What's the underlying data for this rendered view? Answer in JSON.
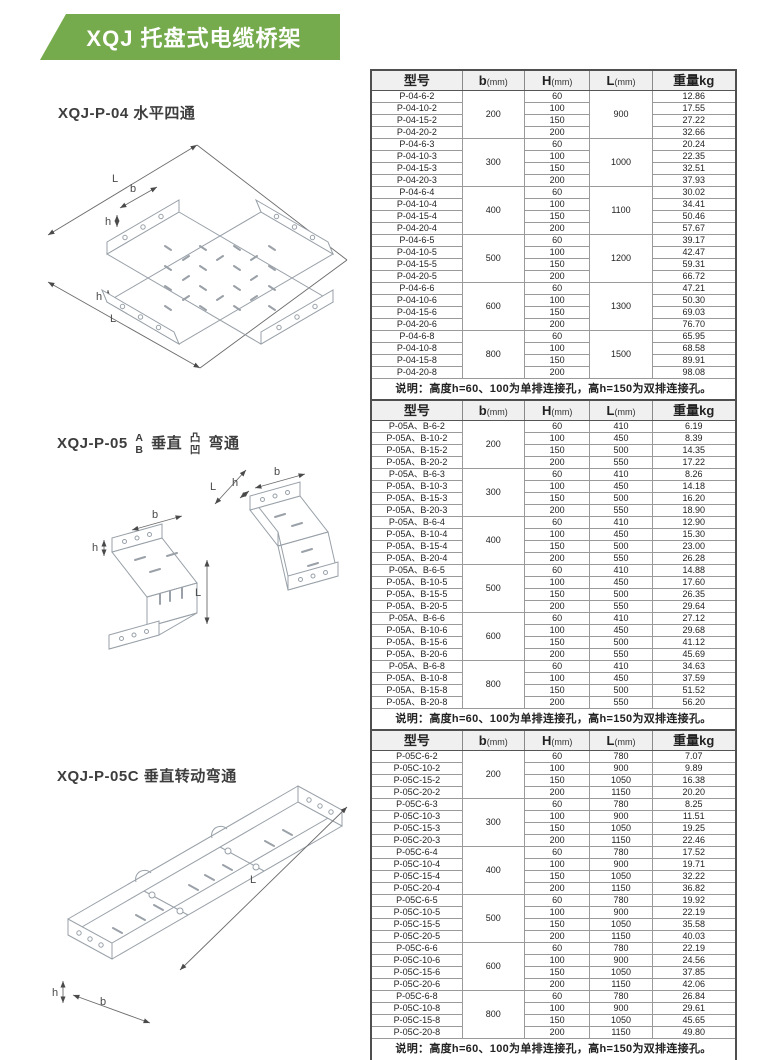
{
  "page": {
    "title": "XQJ 托盘式电缆桥架",
    "banner_color": "#76ab4d"
  },
  "figures": [
    {
      "label": "XQJ-P-04 水平四通",
      "dims": [
        "L",
        "b",
        "h",
        "h",
        "L"
      ]
    },
    {
      "parts": {
        "prefix": "XQJ-P-05",
        "ab": [
          "A",
          "B"
        ],
        "mid": "垂直",
        "tuao": [
          "凸",
          "凹"
        ],
        "suffix": "弯通"
      },
      "dims": [
        "h",
        "b",
        "L",
        "L",
        "h",
        "b"
      ]
    },
    {
      "label": "XQJ-P-05C 垂直转动弯通",
      "dims": [
        "L",
        "h",
        "b"
      ]
    }
  ],
  "tables": [
    {
      "headers": [
        {
          "t": "型号"
        },
        {
          "t": "b",
          "u": "(mm)"
        },
        {
          "t": "H",
          "u": "(mm)"
        },
        {
          "t": "L",
          "u": "(mm)"
        },
        {
          "t": "重量kg"
        }
      ],
      "note": "说明：高度h=60、100为单排连接孔，高h=150为双排连接孔。",
      "groups": [
        {
          "b": "200",
          "L": "900",
          "rows": [
            [
              "P-04-6-2",
              "60",
              "12.86"
            ],
            [
              "P-04-10-2",
              "100",
              "17.55"
            ],
            [
              "P-04-15-2",
              "150",
              "27.22"
            ],
            [
              "P-04-20-2",
              "200",
              "32.66"
            ]
          ]
        },
        {
          "b": "300",
          "L": "1000",
          "rows": [
            [
              "P-04-6-3",
              "60",
              "20.24"
            ],
            [
              "P-04-10-3",
              "100",
              "22.35"
            ],
            [
              "P-04-15-3",
              "150",
              "32.51"
            ],
            [
              "P-04-20-3",
              "200",
              "37.93"
            ]
          ]
        },
        {
          "b": "400",
          "L": "1100",
          "rows": [
            [
              "P-04-6-4",
              "60",
              "30.02"
            ],
            [
              "P-04-10-4",
              "100",
              "34.41"
            ],
            [
              "P-04-15-4",
              "150",
              "50.46"
            ],
            [
              "P-04-20-4",
              "200",
              "57.67"
            ]
          ]
        },
        {
          "b": "500",
          "L": "1200",
          "rows": [
            [
              "P-04-6-5",
              "60",
              "39.17"
            ],
            [
              "P-04-10-5",
              "100",
              "42.47"
            ],
            [
              "P-04-15-5",
              "150",
              "59.31"
            ],
            [
              "P-04-20-5",
              "200",
              "66.72"
            ]
          ]
        },
        {
          "b": "600",
          "L": "1300",
          "rows": [
            [
              "P-04-6-6",
              "60",
              "47.21"
            ],
            [
              "P-04-10-6",
              "100",
              "50.30"
            ],
            [
              "P-04-15-6",
              "150",
              "69.03"
            ],
            [
              "P-04-20-6",
              "200",
              "76.70"
            ]
          ]
        },
        {
          "b": "800",
          "L": "1500",
          "rows": [
            [
              "P-04-6-8",
              "60",
              "65.95"
            ],
            [
              "P-04-10-8",
              "100",
              "68.58"
            ],
            [
              "P-04-15-8",
              "150",
              "89.91"
            ],
            [
              "P-04-20-8",
              "200",
              "98.08"
            ]
          ]
        }
      ]
    },
    {
      "headers": [
        {
          "t": "型号"
        },
        {
          "t": "b",
          "u": "(mm)"
        },
        {
          "t": "H",
          "u": "(mm)"
        },
        {
          "t": "L",
          "u": "(mm)"
        },
        {
          "t": "重量kg"
        }
      ],
      "note": "说明：高度h=60、100为单排连接孔，高h=150为双排连接孔。",
      "groups": [
        {
          "b": "200",
          "rows": [
            [
              "P-05A、B-6-2",
              "60",
              "410",
              "6.19"
            ],
            [
              "P-05A、B-10-2",
              "100",
              "450",
              "8.39"
            ],
            [
              "P-05A、B-15-2",
              "150",
              "500",
              "14.35"
            ],
            [
              "P-05A、B-20-2",
              "200",
              "550",
              "17.22"
            ]
          ]
        },
        {
          "b": "300",
          "rows": [
            [
              "P-05A、B-6-3",
              "60",
              "410",
              "8.26"
            ],
            [
              "P-05A、B-10-3",
              "100",
              "450",
              "14.18"
            ],
            [
              "P-05A、B-15-3",
              "150",
              "500",
              "16.20"
            ],
            [
              "P-05A、B-20-3",
              "200",
              "550",
              "18.90"
            ]
          ]
        },
        {
          "b": "400",
          "rows": [
            [
              "P-05A、B-6-4",
              "60",
              "410",
              "12.90"
            ],
            [
              "P-05A、B-10-4",
              "100",
              "450",
              "15.30"
            ],
            [
              "P-05A、B-15-4",
              "150",
              "500",
              "23.00"
            ],
            [
              "P-05A、B-20-4",
              "200",
              "550",
              "26.28"
            ]
          ]
        },
        {
          "b": "500",
          "rows": [
            [
              "P-05A、B-6-5",
              "60",
              "410",
              "14.88"
            ],
            [
              "P-05A、B-10-5",
              "100",
              "450",
              "17.60"
            ],
            [
              "P-05A、B-15-5",
              "150",
              "500",
              "26.35"
            ],
            [
              "P-05A、B-20-5",
              "200",
              "550",
              "29.64"
            ]
          ]
        },
        {
          "b": "600",
          "rows": [
            [
              "P-05A、B-6-6",
              "60",
              "410",
              "27.12"
            ],
            [
              "P-05A、B-10-6",
              "100",
              "450",
              "29.68"
            ],
            [
              "P-05A、B-15-6",
              "150",
              "500",
              "41.12"
            ],
            [
              "P-05A、B-20-6",
              "200",
              "550",
              "45.69"
            ]
          ]
        },
        {
          "b": "800",
          "rows": [
            [
              "P-05A、B-6-8",
              "60",
              "410",
              "34.63"
            ],
            [
              "P-05A、B-10-8",
              "100",
              "450",
              "37.59"
            ],
            [
              "P-05A、B-15-8",
              "150",
              "500",
              "51.52"
            ],
            [
              "P-05A、B-20-8",
              "200",
              "550",
              "56.20"
            ]
          ]
        }
      ]
    },
    {
      "headers": [
        {
          "t": "型号"
        },
        {
          "t": "b",
          "u": "(mm)"
        },
        {
          "t": "H",
          "u": "(mm)"
        },
        {
          "t": "L",
          "u": "(mm)"
        },
        {
          "t": "重量kg"
        }
      ],
      "note": "说明：高度h=60、100为单排连接孔，高h=150为双排连接孔。",
      "groups": [
        {
          "b": "200",
          "rows": [
            [
              "P-05C-6-2",
              "60",
              "780",
              "7.07"
            ],
            [
              "P-05C-10-2",
              "100",
              "900",
              "9.89"
            ],
            [
              "P-05C-15-2",
              "150",
              "1050",
              "16.38"
            ],
            [
              "P-05C-20-2",
              "200",
              "1150",
              "20.20"
            ]
          ]
        },
        {
          "b": "300",
          "rows": [
            [
              "P-05C-6-3",
              "60",
              "780",
              "8.25"
            ],
            [
              "P-05C-10-3",
              "100",
              "900",
              "11.51"
            ],
            [
              "P-05C-15-3",
              "150",
              "1050",
              "19.25"
            ],
            [
              "P-05C-20-3",
              "200",
              "1150",
              "22.46"
            ]
          ]
        },
        {
          "b": "400",
          "rows": [
            [
              "P-05C-6-4",
              "60",
              "780",
              "17.52"
            ],
            [
              "P-05C-10-4",
              "100",
              "900",
              "19.71"
            ],
            [
              "P-05C-15-4",
              "150",
              "1050",
              "32.22"
            ],
            [
              "P-05C-20-4",
              "200",
              "1150",
              "36.82"
            ]
          ]
        },
        {
          "b": "500",
          "rows": [
            [
              "P-05C-6-5",
              "60",
              "780",
              "19.92"
            ],
            [
              "P-05C-10-5",
              "100",
              "900",
              "22.19"
            ],
            [
              "P-05C-15-5",
              "150",
              "1050",
              "35.58"
            ],
            [
              "P-05C-20-5",
              "200",
              "1150",
              "40.03"
            ]
          ]
        },
        {
          "b": "600",
          "rows": [
            [
              "P-05C-6-6",
              "60",
              "780",
              "22.19"
            ],
            [
              "P-05C-10-6",
              "100",
              "900",
              "24.56"
            ],
            [
              "P-05C-15-6",
              "150",
              "1050",
              "37.85"
            ],
            [
              "P-05C-20-6",
              "200",
              "1150",
              "42.06"
            ]
          ]
        },
        {
          "b": "800",
          "rows": [
            [
              "P-05C-6-8",
              "60",
              "780",
              "26.84"
            ],
            [
              "P-05C-10-8",
              "100",
              "900",
              "29.61"
            ],
            [
              "P-05C-15-8",
              "150",
              "1050",
              "45.65"
            ],
            [
              "P-05C-20-8",
              "200",
              "1150",
              "49.80"
            ]
          ]
        }
      ]
    }
  ]
}
